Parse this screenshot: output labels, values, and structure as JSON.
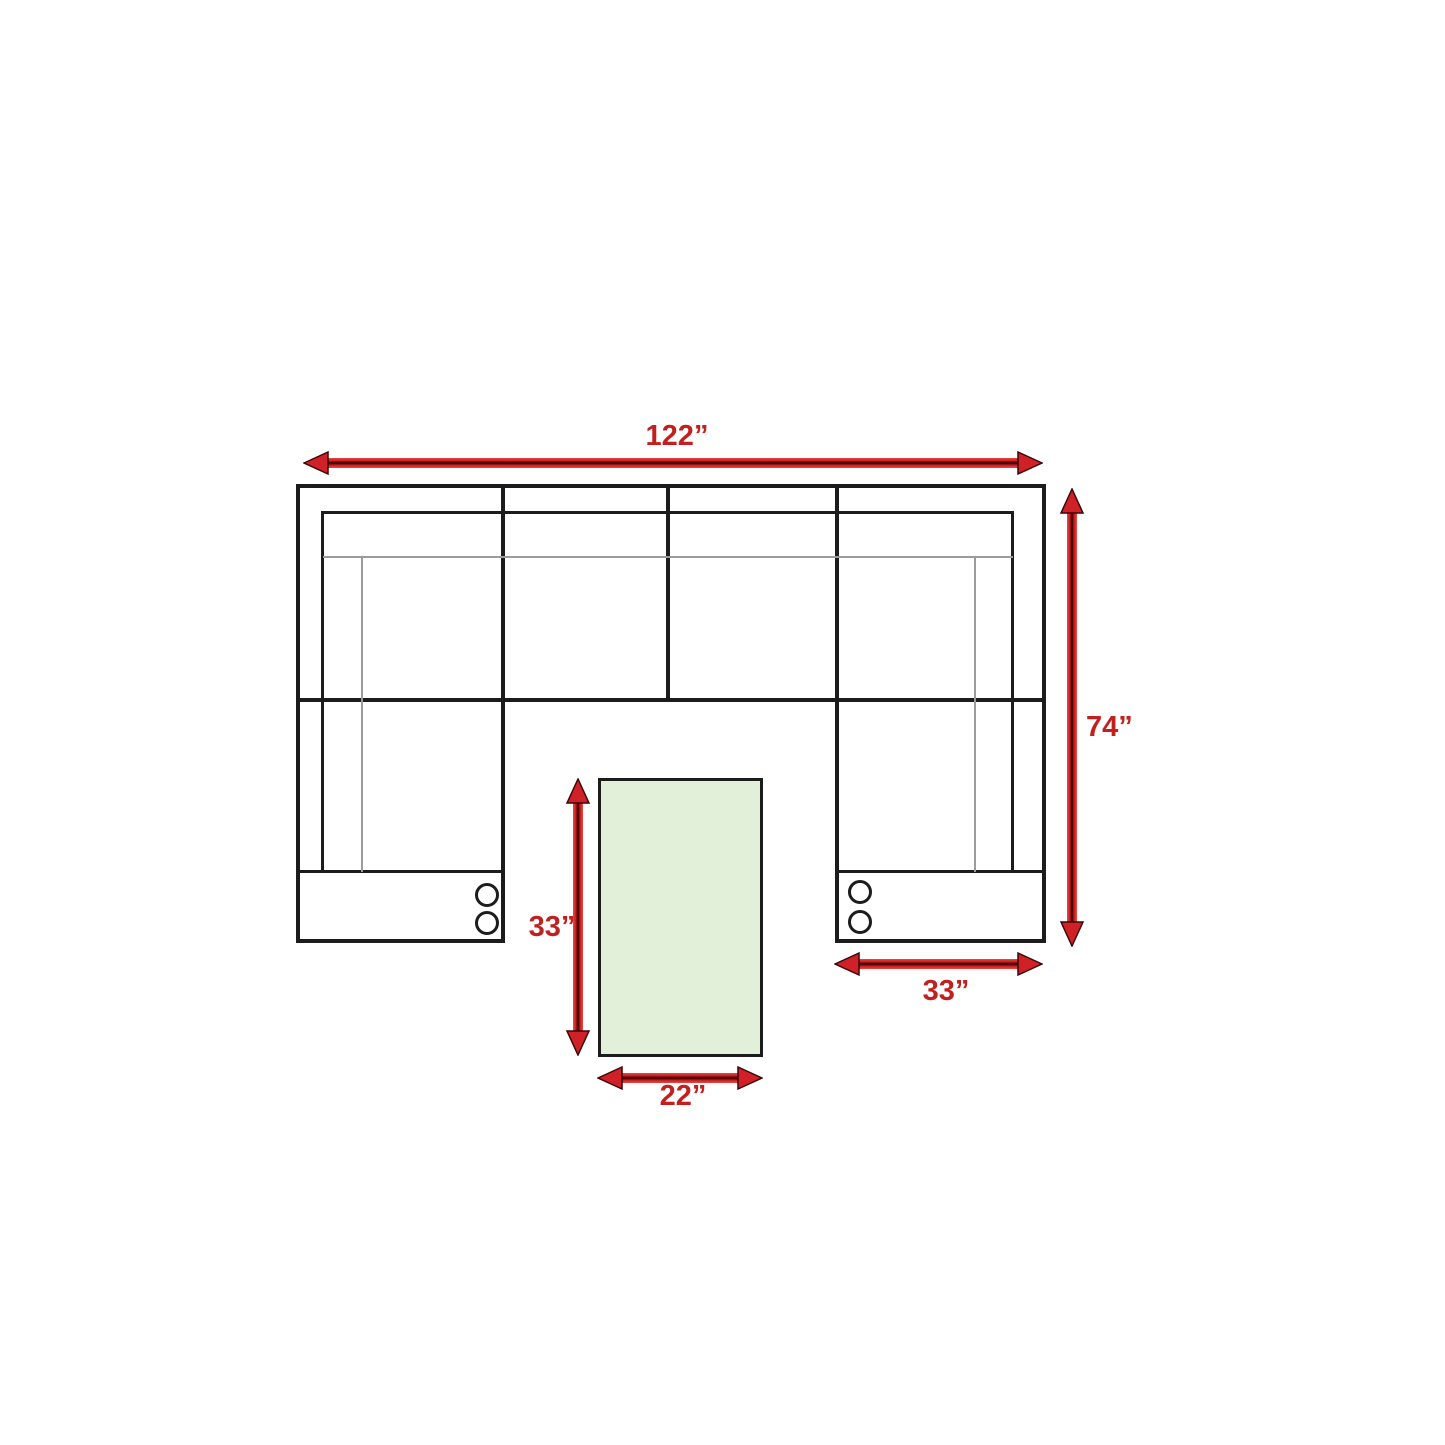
{
  "diagram": {
    "type": "sectional-sofa-floor-plan-with-ottoman",
    "colors": {
      "line_black": "#1c1c1c",
      "thin_gray": "#9b9b9b",
      "arrow_red": "#d02128",
      "label_red": "#c2201f",
      "table_green": "#e2efd9"
    },
    "icons": {
      "cupholder": "outlined-circle",
      "dimension_arrow": "double-headed-red-arrow"
    },
    "dimensions": {
      "overall_width": {
        "label": "122”",
        "inches": 122
      },
      "overall_depth": {
        "label": "74”",
        "inches": 74
      },
      "ottoman_length": {
        "label": "33”",
        "inches": 33
      },
      "section_width": {
        "label": "33”",
        "inches": 33
      },
      "ottoman_width": {
        "label": "22”",
        "inches": 22
      }
    }
  }
}
